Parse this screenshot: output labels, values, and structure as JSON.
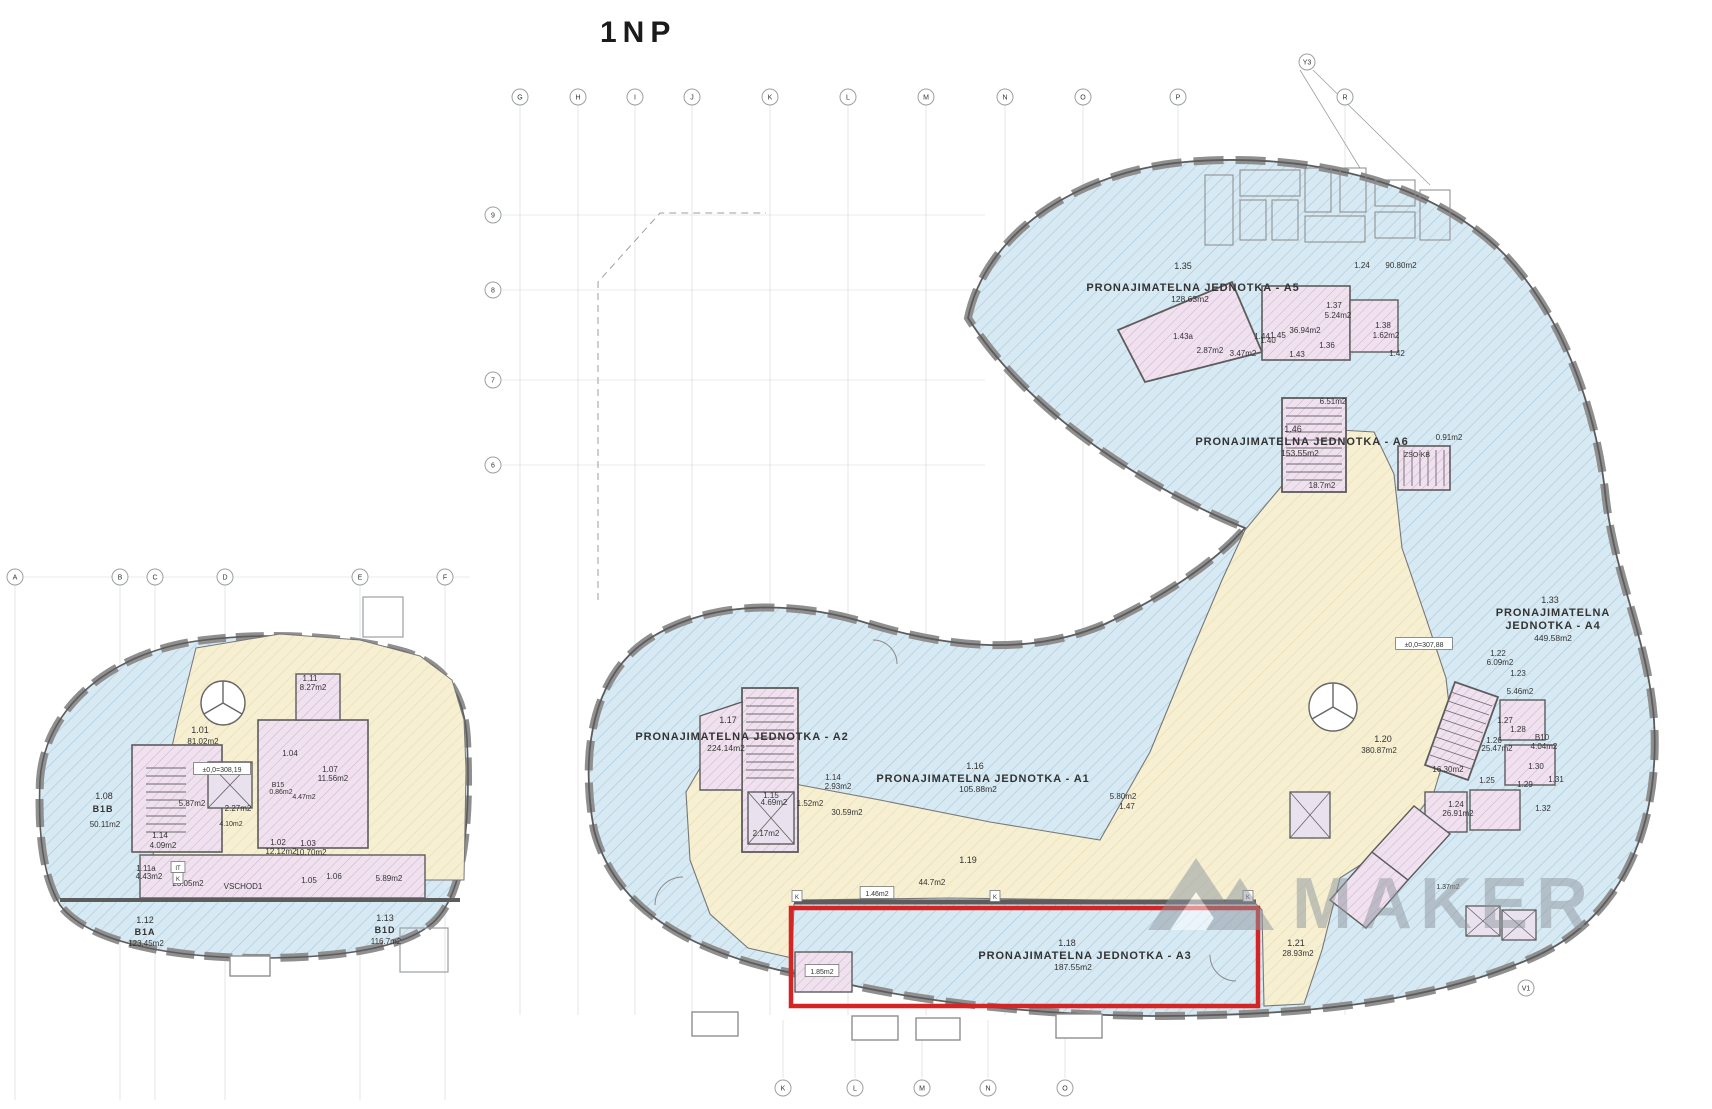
{
  "title": "1NP",
  "watermark": {
    "text": "MAKER",
    "color": "#8e979e"
  },
  "highlight": {
    "code": "1.18",
    "label": "PRONAJIMATELNA JEDNOTKA - A3",
    "area": "187.55m2",
    "color": "#d42424"
  },
  "colors": {
    "unit_fill": "#d7e9f3",
    "unit_hatch": "#a3c8da",
    "common_fill": "#f6efd1",
    "common_hatch": "#e3d3a0",
    "core_fill": "#f0e1ef",
    "core_hatch": "#d3aed2",
    "wall": "#5c5c5c",
    "facade": "#8f8f8f",
    "grid": "#c7cbce",
    "highlight": "#d42424",
    "watermark": "#8e979e",
    "text": "#333333"
  },
  "axes": {
    "top": {
      "y": 97,
      "items": [
        {
          "x": 520,
          "l": "G"
        },
        {
          "x": 578,
          "l": "H"
        },
        {
          "x": 635,
          "l": "I"
        },
        {
          "x": 692,
          "l": "J"
        },
        {
          "x": 770,
          "l": "K"
        },
        {
          "x": 848,
          "l": "L"
        },
        {
          "x": 926,
          "l": "M"
        },
        {
          "x": 1005,
          "l": "N"
        },
        {
          "x": 1083,
          "l": "O"
        },
        {
          "x": 1178,
          "l": "P"
        },
        {
          "x": 1345,
          "l": "R"
        }
      ]
    },
    "left_row": {
      "y": 577,
      "items": [
        {
          "x": 15,
          "l": "A"
        },
        {
          "x": 120,
          "l": "B"
        },
        {
          "x": 155,
          "l": "C"
        },
        {
          "x": 225,
          "l": "D"
        },
        {
          "x": 360,
          "l": "E"
        },
        {
          "x": 445,
          "l": "F"
        }
      ]
    },
    "left_col": {
      "x": 493,
      "items": [
        {
          "y": 215,
          "l": "9"
        },
        {
          "y": 290,
          "l": "8"
        },
        {
          "y": 380,
          "l": "7"
        },
        {
          "y": 465,
          "l": "6"
        }
      ]
    },
    "bottom": {
      "y": 1088,
      "items": [
        {
          "x": 783,
          "l": "K"
        },
        {
          "x": 855,
          "l": "L"
        },
        {
          "x": 922,
          "l": "M"
        },
        {
          "x": 988,
          "l": "N"
        },
        {
          "x": 1065,
          "l": "O"
        }
      ]
    },
    "extra": [
      {
        "x": 1307,
        "y": 62,
        "l": "Y3"
      },
      {
        "x": 1526,
        "y": 988,
        "l": "V1"
      }
    ]
  },
  "labels": [
    {
      "t": "1.35",
      "x": 1183,
      "y": 269,
      "s": 9
    },
    {
      "t": "PRONAJIMATELNA JEDNOTKA - A5",
      "x": 1193,
      "y": 291,
      "s": 11,
      "b": 1,
      "n": "unit-a5-label"
    },
    {
      "t": "128.63m2",
      "x": 1190,
      "y": 302,
      "s": 8.5
    },
    {
      "t": "1.46",
      "x": 1293,
      "y": 432,
      "s": 9
    },
    {
      "t": "PRONAJIMATELNA JEDNOTKA - A6",
      "x": 1302,
      "y": 445,
      "s": 11,
      "b": 1,
      "n": "unit-a6-label"
    },
    {
      "t": "153.55m2",
      "x": 1300,
      "y": 456,
      "s": 8.5
    },
    {
      "t": "1.33",
      "x": 1550,
      "y": 603,
      "s": 9
    },
    {
      "t": "PRONAJIMATELNA",
      "x": 1553,
      "y": 616,
      "s": 11,
      "b": 1,
      "n": "unit-a4-label"
    },
    {
      "t": "JEDNOTKA - A4",
      "x": 1553,
      "y": 629,
      "s": 11,
      "b": 1,
      "n": "unit-a4-label-2"
    },
    {
      "t": "449.58m2",
      "x": 1553,
      "y": 641,
      "s": 8.5
    },
    {
      "t": "1.17",
      "x": 728,
      "y": 723,
      "s": 9
    },
    {
      "t": "PRONAJIMATELNA JEDNOTKA - A2",
      "x": 742,
      "y": 740,
      "s": 11,
      "b": 1,
      "n": "unit-a2-label"
    },
    {
      "t": "224.14m2",
      "x": 726,
      "y": 751,
      "s": 8.5
    },
    {
      "t": "1.16",
      "x": 975,
      "y": 769,
      "s": 9
    },
    {
      "t": "PRONAJIMATELNA JEDNOTKA - A1",
      "x": 983,
      "y": 782,
      "s": 11,
      "b": 1,
      "n": "unit-a1-label"
    },
    {
      "t": "105.88m2",
      "x": 978,
      "y": 792,
      "s": 8.5
    },
    {
      "t": "1.18",
      "x": 1067,
      "y": 946,
      "s": 9
    },
    {
      "t": "PRONAJIMATELNA JEDNOTKA - A3",
      "x": 1085,
      "y": 959,
      "s": 11,
      "b": 1,
      "n": "unit-a3-label"
    },
    {
      "t": "187.55m2",
      "x": 1073,
      "y": 970,
      "s": 8.5
    },
    {
      "t": "1.19",
      "x": 968,
      "y": 863,
      "s": 9
    },
    {
      "t": "44.7m2",
      "x": 932,
      "y": 885,
      "s": 8
    },
    {
      "t": "1.20",
      "x": 1383,
      "y": 742,
      "s": 9
    },
    {
      "t": "380.87m2",
      "x": 1379,
      "y": 753,
      "s": 8
    },
    {
      "t": "1.21",
      "x": 1296,
      "y": 946,
      "s": 9
    },
    {
      "t": "28.93m2",
      "x": 1298,
      "y": 956,
      "s": 8
    },
    {
      "t": "1.22",
      "x": 1498,
      "y": 656,
      "s": 8
    },
    {
      "t": "6.09m2",
      "x": 1500,
      "y": 665,
      "s": 8
    },
    {
      "t": "1.23",
      "x": 1518,
      "y": 676,
      "s": 8
    },
    {
      "t": "5.46m2",
      "x": 1520,
      "y": 694,
      "s": 8
    },
    {
      "t": "1.27",
      "x": 1505,
      "y": 723,
      "s": 8
    },
    {
      "t": "1.28",
      "x": 1518,
      "y": 732,
      "s": 8
    },
    {
      "t": "1.26",
      "x": 1494,
      "y": 743,
      "s": 8
    },
    {
      "t": "25.47m2",
      "x": 1497,
      "y": 751,
      "s": 8
    },
    {
      "t": "B10",
      "x": 1542,
      "y": 740,
      "s": 8
    },
    {
      "t": "4.04m2",
      "x": 1544,
      "y": 749,
      "s": 8
    },
    {
      "t": "1.30",
      "x": 1536,
      "y": 769,
      "s": 8
    },
    {
      "t": "1.25",
      "x": 1487,
      "y": 783,
      "s": 8
    },
    {
      "t": "1.29",
      "x": 1525,
      "y": 787,
      "s": 8
    },
    {
      "t": "1.31",
      "x": 1556,
      "y": 782,
      "s": 8
    },
    {
      "t": "1.32",
      "x": 1543,
      "y": 811,
      "s": 8
    },
    {
      "t": "1.24",
      "x": 1456,
      "y": 807,
      "s": 8
    },
    {
      "t": "26.91m2",
      "x": 1458,
      "y": 816,
      "s": 8
    },
    {
      "t": "16.30m2",
      "x": 1448,
      "y": 772,
      "s": 8
    },
    {
      "t": "5.80m2",
      "x": 1123,
      "y": 799,
      "s": 8
    },
    {
      "t": "1.47",
      "x": 1127,
      "y": 809,
      "s": 8
    },
    {
      "t": "1.14",
      "x": 833,
      "y": 780,
      "s": 8
    },
    {
      "t": "2.93m2",
      "x": 838,
      "y": 789,
      "s": 8
    },
    {
      "t": "1.15",
      "x": 771,
      "y": 798,
      "s": 8
    },
    {
      "t": "4.69m2",
      "x": 774,
      "y": 805,
      "s": 8
    },
    {
      "t": "30.59m2",
      "x": 847,
      "y": 815,
      "s": 8
    },
    {
      "t": "1.52m2",
      "x": 810,
      "y": 806,
      "s": 8
    },
    {
      "t": "2.17m2",
      "x": 766,
      "y": 836,
      "s": 8
    },
    {
      "t": "1.46m2",
      "x": 877,
      "y": 896,
      "s": 7,
      "box": 1
    },
    {
      "t": "1.85m2",
      "x": 822,
      "y": 974,
      "s": 7,
      "box": 1
    },
    {
      "t": "1.37m2",
      "x": 1448,
      "y": 889,
      "s": 7
    },
    {
      "t": "6.51m2",
      "x": 1333,
      "y": 404,
      "s": 8
    },
    {
      "t": "0.91m2",
      "x": 1449,
      "y": 440,
      "s": 8
    },
    {
      "t": "ZSO-KB",
      "x": 1417,
      "y": 457,
      "s": 7
    },
    {
      "t": "18.7m2",
      "x": 1322,
      "y": 488,
      "s": 8
    },
    {
      "t": "1.24",
      "x": 1362,
      "y": 268,
      "s": 8
    },
    {
      "t": "90.80m2",
      "x": 1401,
      "y": 268,
      "s": 8
    },
    {
      "t": "1.37",
      "x": 1334,
      "y": 308,
      "s": 8
    },
    {
      "t": "5.24m2",
      "x": 1338,
      "y": 318,
      "s": 8
    },
    {
      "t": "36.94m2",
      "x": 1305,
      "y": 333,
      "s": 8
    },
    {
      "t": "1.43",
      "x": 1297,
      "y": 357,
      "s": 8
    },
    {
      "t": "1.36",
      "x": 1327,
      "y": 348,
      "s": 8
    },
    {
      "t": "1.44",
      "x": 1262,
      "y": 339,
      "s": 8
    },
    {
      "t": "1.45",
      "x": 1278,
      "y": 338,
      "s": 8
    },
    {
      "t": "3.47m2",
      "x": 1243,
      "y": 356,
      "s": 8
    },
    {
      "t": "1.38",
      "x": 1383,
      "y": 328,
      "s": 8
    },
    {
      "t": "1.62m2",
      "x": 1386,
      "y": 338,
      "s": 8
    },
    {
      "t": "1.42",
      "x": 1397,
      "y": 356,
      "s": 8
    },
    {
      "t": "1.43a",
      "x": 1183,
      "y": 339,
      "s": 8
    },
    {
      "t": "2.87m2",
      "x": 1210,
      "y": 353,
      "s": 8
    },
    {
      "t": "1.40",
      "x": 1268,
      "y": 343,
      "s": 8
    },
    {
      "t": "±0,0=307,88",
      "x": 1424,
      "y": 647,
      "s": 7,
      "box": 1
    },
    {
      "t": "±0,0=308,19",
      "x": 222,
      "y": 772,
      "s": 7,
      "box": 1
    },
    {
      "t": "1.01",
      "x": 200,
      "y": 733,
      "s": 9
    },
    {
      "t": "81.02m2",
      "x": 203,
      "y": 744,
      "s": 8
    },
    {
      "t": "1.08",
      "x": 104,
      "y": 799,
      "s": 9
    },
    {
      "t": "B1B",
      "x": 103,
      "y": 812,
      "s": 9,
      "b": 1
    },
    {
      "t": "50.11m2",
      "x": 105,
      "y": 827,
      "s": 8
    },
    {
      "t": "1.12",
      "x": 145,
      "y": 923,
      "s": 9
    },
    {
      "t": "B1A",
      "x": 145,
      "y": 935,
      "s": 9,
      "b": 1
    },
    {
      "t": "123.45m2",
      "x": 146,
      "y": 946,
      "s": 8
    },
    {
      "t": "1.13",
      "x": 385,
      "y": 921,
      "s": 9
    },
    {
      "t": "B1D",
      "x": 385,
      "y": 933,
      "s": 9,
      "b": 1
    },
    {
      "t": "116.7m2",
      "x": 386,
      "y": 944,
      "s": 8
    },
    {
      "t": "1.14",
      "x": 160,
      "y": 838,
      "s": 8
    },
    {
      "t": "4.09m2",
      "x": 163,
      "y": 848,
      "s": 8
    },
    {
      "t": "1.11a",
      "x": 146,
      "y": 871,
      "s": 8
    },
    {
      "t": "4.43m2",
      "x": 149,
      "y": 879,
      "s": 8
    },
    {
      "t": "23.05m2",
      "x": 188,
      "y": 886,
      "s": 8
    },
    {
      "t": "VSCHOD1",
      "x": 243,
      "y": 889,
      "s": 8
    },
    {
      "t": "1.02",
      "x": 278,
      "y": 845,
      "s": 8
    },
    {
      "t": "12.12m2",
      "x": 281,
      "y": 854,
      "s": 8
    },
    {
      "t": "1.03",
      "x": 308,
      "y": 846,
      "s": 8
    },
    {
      "t": "10.70m2",
      "x": 311,
      "y": 855,
      "s": 8
    },
    {
      "t": "1.04",
      "x": 290,
      "y": 756,
      "s": 8
    },
    {
      "t": "1.05",
      "x": 309,
      "y": 883,
      "s": 8
    },
    {
      "t": "1.06",
      "x": 334,
      "y": 879,
      "s": 8
    },
    {
      "t": "1.07",
      "x": 330,
      "y": 772,
      "s": 8
    },
    {
      "t": "11.56m2",
      "x": 333,
      "y": 781,
      "s": 8
    },
    {
      "t": "5.89m2",
      "x": 389,
      "y": 881,
      "s": 8
    },
    {
      "t": "1.11",
      "x": 310,
      "y": 681,
      "s": 8
    },
    {
      "t": "8.27m2",
      "x": 313,
      "y": 690,
      "s": 8
    },
    {
      "t": "5.87m2",
      "x": 192,
      "y": 806,
      "s": 8
    },
    {
      "t": "2.27m2",
      "x": 238,
      "y": 811,
      "s": 8
    },
    {
      "t": "B15",
      "x": 278,
      "y": 787,
      "s": 7
    },
    {
      "t": "0.86m2",
      "x": 281,
      "y": 794,
      "s": 7
    },
    {
      "t": "4.10m2",
      "x": 231,
      "y": 826,
      "s": 7
    },
    {
      "t": "4.47m2",
      "x": 304,
      "y": 799,
      "s": 7
    },
    {
      "t": "K",
      "x": 797,
      "y": 899,
      "s": 6,
      "box": 1
    },
    {
      "t": "K",
      "x": 995,
      "y": 899,
      "s": 6,
      "box": 1
    },
    {
      "t": "K",
      "x": 1248,
      "y": 899,
      "s": 6,
      "box": 1
    },
    {
      "t": "IT",
      "x": 178,
      "y": 870,
      "s": 6,
      "box": 1
    },
    {
      "t": "K",
      "x": 178,
      "y": 881,
      "s": 6,
      "box": 1
    }
  ]
}
